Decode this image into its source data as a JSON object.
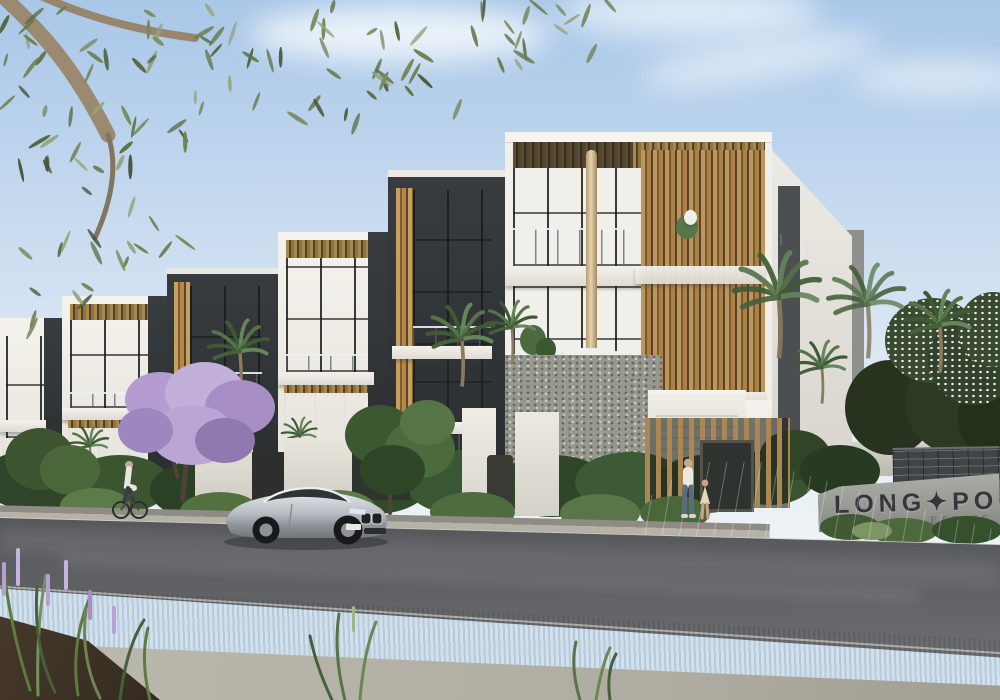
{
  "meta": {
    "type": "architectural-photographic-render",
    "description": "Street view render of a row of modern three-storey townhouses with white, charcoal and timber facades, a silver coupe parked on the road, landscaped verge, palms, a flowering purple tree, pedestrians, a cyclist, and a masonry estate entry sign at right"
  },
  "signage": {
    "line1": "LONG✦POC",
    "line2": "ESTATE"
  },
  "palette": {
    "sky_top": "#a9c7e8",
    "sky_horizon": "#eef3f5",
    "wall_white": "#f1efe9",
    "charcoal": "#34383b",
    "timber": "#b3854a",
    "glass": "#9db1c2",
    "pebble_stone": "#97988f",
    "road_asphalt": "#56585b",
    "grass": "#5d7b49",
    "footpath": "#b8b5ab",
    "flower_purple": "#b7a0d2",
    "sign_brick": "#3f4447",
    "sign_stone": "#9a9c97",
    "car_silver": "#c9ccd1"
  },
  "scene": {
    "objects": [
      {
        "name": "townhouse-row",
        "label": "row of six modern townhouses"
      },
      {
        "name": "main-townhouse",
        "label": "corner townhouse with timber batten screens and glass balconies"
      },
      {
        "name": "silver-coupe",
        "label": "silver coupe parked at kerb"
      },
      {
        "name": "cyclist",
        "label": "cyclist on footpath at left"
      },
      {
        "name": "pedestrians",
        "label": "adult and child walking near entry gate"
      },
      {
        "name": "estate-sign",
        "label": "brick and stone estate entry sign"
      },
      {
        "name": "eucalyptus-branch",
        "label": "overhanging eucalyptus branch, top left"
      },
      {
        "name": "palm-trees",
        "label": "palms along street and at right"
      },
      {
        "name": "purple-tree",
        "label": "purple flowering tree"
      },
      {
        "name": "verge",
        "label": "grass verge, footpath and garden bed with purple flower spikes"
      }
    ]
  }
}
